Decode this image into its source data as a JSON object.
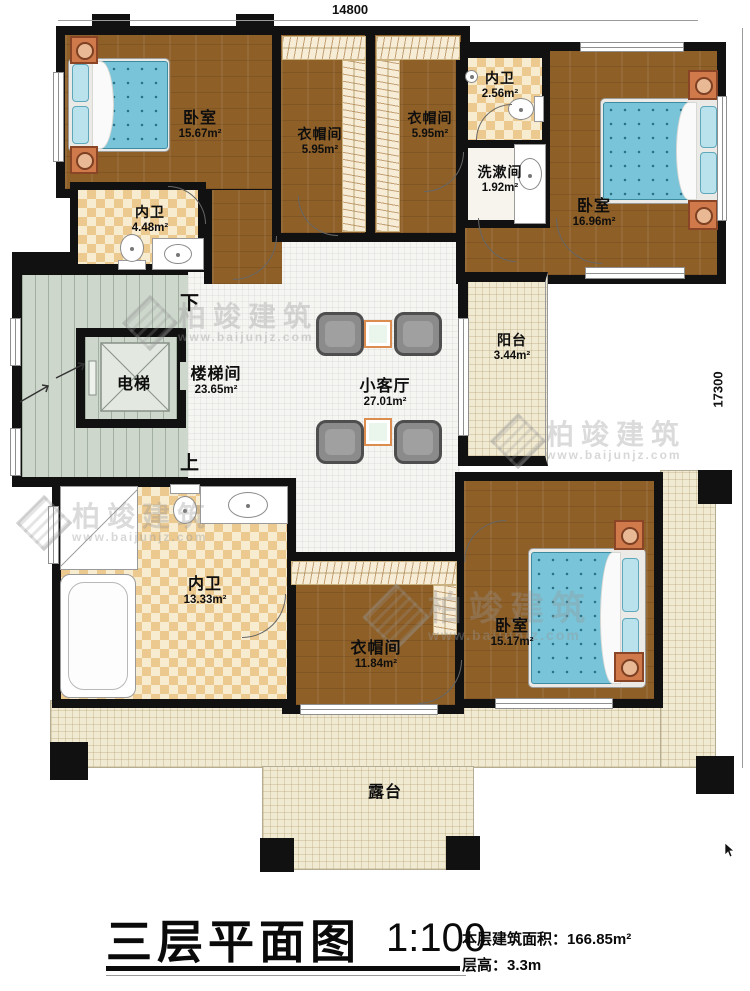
{
  "dimensions": {
    "top": "14800",
    "right": "17300"
  },
  "markers": {
    "down": "下",
    "up": "上"
  },
  "rooms": {
    "bedroom1": {
      "name": "卧室",
      "area": "15.67m²"
    },
    "closet1": {
      "name": "衣帽间",
      "area": "5.95m²"
    },
    "closet2": {
      "name": "衣帽间",
      "area": "5.95m²"
    },
    "bath_top": {
      "name": "内卫",
      "area": "2.56m²"
    },
    "washroom": {
      "name": "洗漱间",
      "area": "1.92m²"
    },
    "bedroom2": {
      "name": "卧室",
      "area": "16.96m²"
    },
    "bath_left": {
      "name": "内卫",
      "area": "4.48m²"
    },
    "elevator": {
      "name": "电梯"
    },
    "stairwell": {
      "name": "楼梯间",
      "area": "23.65m²"
    },
    "living": {
      "name": "小客厅",
      "area": "27.01m²"
    },
    "balcony": {
      "name": "阳台",
      "area": "3.44m²"
    },
    "bath_bottom": {
      "name": "内卫",
      "area": "13.33m²"
    },
    "closet3": {
      "name": "衣帽间",
      "area": "11.84m²"
    },
    "bedroom3": {
      "name": "卧室",
      "area": "15.17m²"
    },
    "terrace": {
      "name": "露台"
    }
  },
  "title": {
    "text": "三层平面图",
    "scale": "1:100",
    "floor_area": "本层建筑面积：166.85m²",
    "floor_height": "层高：3.3m"
  },
  "watermark": {
    "brand": "柏竣建筑",
    "url": "www.baijunjz.com"
  },
  "colors": {
    "wall": "#111111",
    "wood_floor": "#8e5f27",
    "bath_checker": "#ecc98e",
    "stair_floor": "#cdd7cc",
    "terrace_floor": "#f1ead2",
    "bed_mattress": "#79c4d8",
    "nightstand": "#d07a4c"
  }
}
